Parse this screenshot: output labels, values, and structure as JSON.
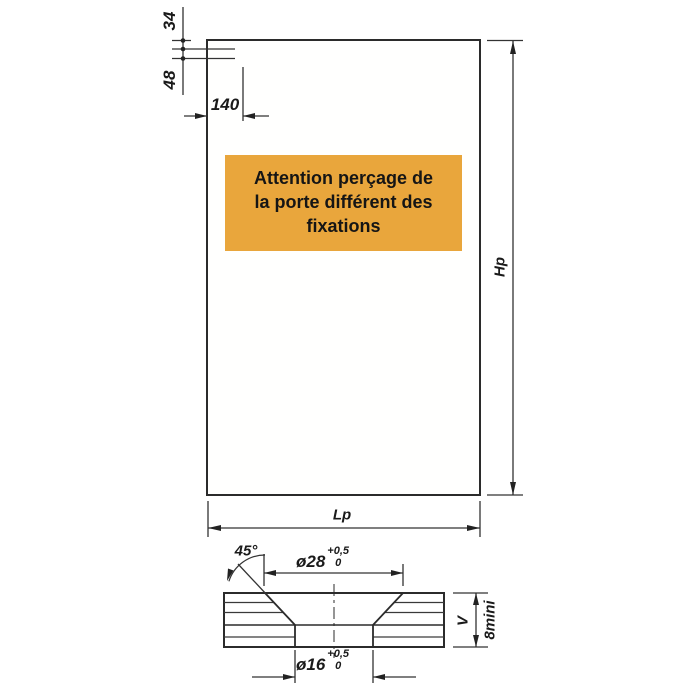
{
  "colors": {
    "line": "#2b2b2b",
    "warning_bg": "#E9A63C",
    "warning_text": "#151515",
    "paper": "#ffffff"
  },
  "warning": {
    "line1": "Attention perçage de",
    "line2": "la porte différent des",
    "line3": "fixations"
  },
  "panel": {
    "height_label": "Hp",
    "width_label": "Lp"
  },
  "top_dimensions": {
    "edge_offset_1": "34",
    "edge_offset_2": "48",
    "horizontal_offset": "140"
  },
  "countersink": {
    "angle": "45°",
    "outer": {
      "dia": "ø28",
      "tol_plus": "+0,5",
      "tol_zero": "0"
    },
    "inner": {
      "dia": "ø16",
      "tol_plus": "+0,5",
      "tol_zero": "0"
    },
    "thickness_label": "V",
    "thickness_min": "8mini"
  }
}
